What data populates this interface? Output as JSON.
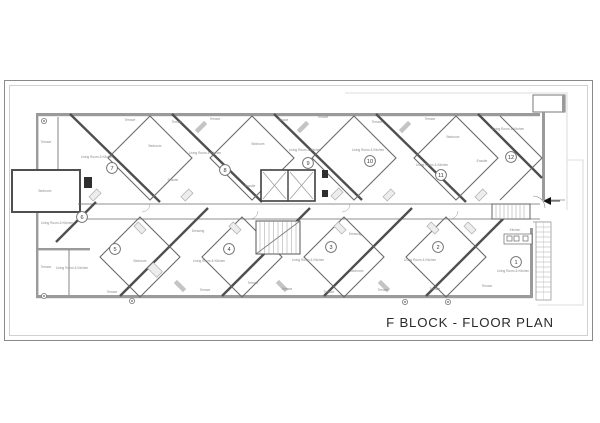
{
  "title": "F BLOCK - FLOOR PLAN",
  "plan": {
    "units": [
      {
        "number": "1",
        "x": 516,
        "y": 262
      },
      {
        "number": "2",
        "x": 438,
        "y": 247
      },
      {
        "number": "3",
        "x": 331,
        "y": 247
      },
      {
        "number": "4",
        "x": 229,
        "y": 249
      },
      {
        "number": "5",
        "x": 115,
        "y": 249
      },
      {
        "number": "6",
        "x": 82,
        "y": 217
      },
      {
        "number": "7",
        "x": 112,
        "y": 168
      },
      {
        "number": "8",
        "x": 225,
        "y": 170
      },
      {
        "number": "9",
        "x": 308,
        "y": 163
      },
      {
        "number": "10",
        "x": 370,
        "y": 161
      },
      {
        "number": "11",
        "x": 441,
        "y": 175
      },
      {
        "number": "12",
        "x": 511,
        "y": 157
      }
    ],
    "room_labels": [
      {
        "text": "Living Room & Kitchen",
        "x": 97,
        "y": 158
      },
      {
        "text": "Living Room & Kitchen",
        "x": 205,
        "y": 154
      },
      {
        "text": "Living Room & Kitchen",
        "x": 305,
        "y": 151
      },
      {
        "text": "Living Room & Kitchen",
        "x": 368,
        "y": 151
      },
      {
        "text": "Living Room & Kitchen",
        "x": 432,
        "y": 166
      },
      {
        "text": "Living Room & Kitchen",
        "x": 508,
        "y": 130
      },
      {
        "text": "Living Room & Kitchen",
        "x": 57,
        "y": 224
      },
      {
        "text": "Living Room & Kitchen",
        "x": 72,
        "y": 269
      },
      {
        "text": "Living Room & Kitchen",
        "x": 209,
        "y": 262
      },
      {
        "text": "Living Room & Kitchen",
        "x": 308,
        "y": 261
      },
      {
        "text": "Living Room & Kitchen",
        "x": 420,
        "y": 261
      },
      {
        "text": "Living Room & Kitchen",
        "x": 513,
        "y": 272
      },
      {
        "text": "Bedroom",
        "x": 155,
        "y": 147
      },
      {
        "text": "Bedroom",
        "x": 258,
        "y": 145
      },
      {
        "text": "Bedroom",
        "x": 453,
        "y": 138
      },
      {
        "text": "Bedroom",
        "x": 45,
        "y": 192
      },
      {
        "text": "Bedroom",
        "x": 140,
        "y": 262
      },
      {
        "text": "Bedroom",
        "x": 357,
        "y": 272
      },
      {
        "text": "Terrace",
        "x": 130,
        "y": 121
      },
      {
        "text": "Terrace",
        "x": 177,
        "y": 123
      },
      {
        "text": "Terrace",
        "x": 215,
        "y": 120
      },
      {
        "text": "Terrace",
        "x": 283,
        "y": 121
      },
      {
        "text": "Terrace",
        "x": 323,
        "y": 118
      },
      {
        "text": "Terrace",
        "x": 377,
        "y": 123
      },
      {
        "text": "Terrace",
        "x": 430,
        "y": 120
      },
      {
        "text": "Terrace",
        "x": 46,
        "y": 143
      },
      {
        "text": "Terrace",
        "x": 46,
        "y": 268
      },
      {
        "text": "Terrace",
        "x": 112,
        "y": 293
      },
      {
        "text": "Terrace",
        "x": 205,
        "y": 291
      },
      {
        "text": "Terrace",
        "x": 253,
        "y": 284
      },
      {
        "text": "Terrace",
        "x": 287,
        "y": 290
      },
      {
        "text": "Terrace",
        "x": 329,
        "y": 293
      },
      {
        "text": "Terrace",
        "x": 383,
        "y": 291
      },
      {
        "text": "Terrace",
        "x": 435,
        "y": 290
      },
      {
        "text": "Terrace",
        "x": 487,
        "y": 287
      },
      {
        "text": "Dressing",
        "x": 198,
        "y": 232
      },
      {
        "text": "Dressing",
        "x": 355,
        "y": 235
      },
      {
        "text": "Ensuite",
        "x": 173,
        "y": 181
      },
      {
        "text": "Ensuite",
        "x": 250,
        "y": 187
      },
      {
        "text": "Ensuite",
        "x": 482,
        "y": 162
      },
      {
        "text": "Kitchen",
        "x": 515,
        "y": 231
      }
    ],
    "columns": [
      {
        "x": 44,
        "y": 121
      },
      {
        "x": 44,
        "y": 296
      },
      {
        "x": 132,
        "y": 301
      },
      {
        "x": 405,
        "y": 302
      },
      {
        "x": 448,
        "y": 302
      }
    ],
    "colors": {
      "wall": "#4f4f4f",
      "wall_fill": "#9a9a9a",
      "boundary": "#d0d0d0",
      "ink": "#2a2a2a",
      "label": "#8a8a8a"
    }
  }
}
